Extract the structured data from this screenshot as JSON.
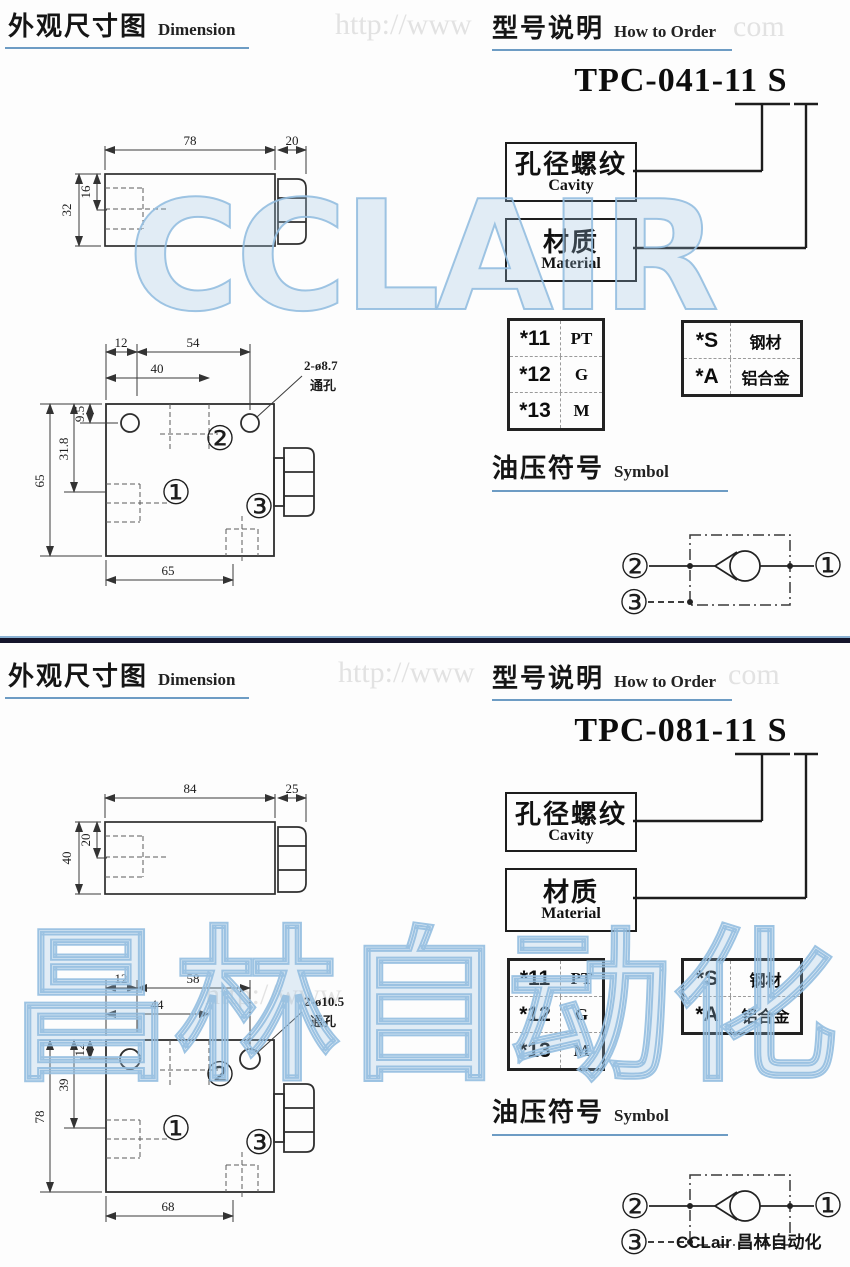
{
  "watermarks": {
    "cclair": "CCLAIR",
    "changlin": "昌林自动化",
    "url_a": "http://www",
    "url_b": "com",
    "blue": "#93bee0",
    "gray": "#bdbdbd"
  },
  "footer": {
    "brand": "CCLair 昌林自动化"
  },
  "sections": [
    {
      "dim_title_zh": "外观尺寸图",
      "dim_title_en": "Dimension",
      "order_title_zh": "型号说明",
      "order_title_en": "How to Order",
      "model": "TPC-041-11 S",
      "cavity_zh": "孔径螺纹",
      "cavity_en": "Cavity",
      "material_zh": "材质",
      "material_en": "Material",
      "thread_options": [
        {
          "code": "*11",
          "value": "PT"
        },
        {
          "code": "*12",
          "value": "G"
        },
        {
          "code": "*13",
          "value": "M"
        }
      ],
      "material_options": [
        {
          "code": "*S",
          "value": "钢材"
        },
        {
          "code": "*A",
          "value": "铝合金"
        }
      ],
      "symbol_title_zh": "油压符号",
      "symbol_title_en": "Symbol",
      "ports": {
        "p1": "①",
        "p2": "②",
        "p3": "③"
      },
      "side_view": {
        "length": "78",
        "nut": "20",
        "height": "32",
        "bore": "16"
      },
      "top_view": {
        "offset_x": "12",
        "span_x": "54",
        "mid_x": "40",
        "offset_y": "9.5",
        "mid_y": "31.8",
        "height": "65",
        "width": "65",
        "callout": "2-ø8.7",
        "callout2": "通孔"
      }
    },
    {
      "dim_title_zh": "外观尺寸图",
      "dim_title_en": "Dimension",
      "order_title_zh": "型号说明",
      "order_title_en": "How to Order",
      "model": "TPC-081-11 S",
      "cavity_zh": "孔径螺纹",
      "cavity_en": "Cavity",
      "material_zh": "材质",
      "material_en": "Material",
      "thread_options": [
        {
          "code": "*11",
          "value": "PT"
        },
        {
          "code": "*12",
          "value": "G"
        },
        {
          "code": "*13",
          "value": "M"
        }
      ],
      "material_options": [
        {
          "code": "*S",
          "value": "钢材"
        },
        {
          "code": "*A",
          "value": "铝合金"
        }
      ],
      "symbol_title_zh": "油压符号",
      "symbol_title_en": "Symbol",
      "ports": {
        "p1": "①",
        "p2": "②",
        "p3": "③"
      },
      "side_view": {
        "length": "84",
        "nut": "25",
        "height": "40",
        "bore": "20"
      },
      "top_view": {
        "offset_x": "12",
        "span_x": "58",
        "mid_x": "44",
        "offset_y": "12",
        "mid_y": "39",
        "height": "78",
        "width": "68",
        "callout": "2-ø10.5",
        "callout2": "通孔"
      }
    }
  ]
}
